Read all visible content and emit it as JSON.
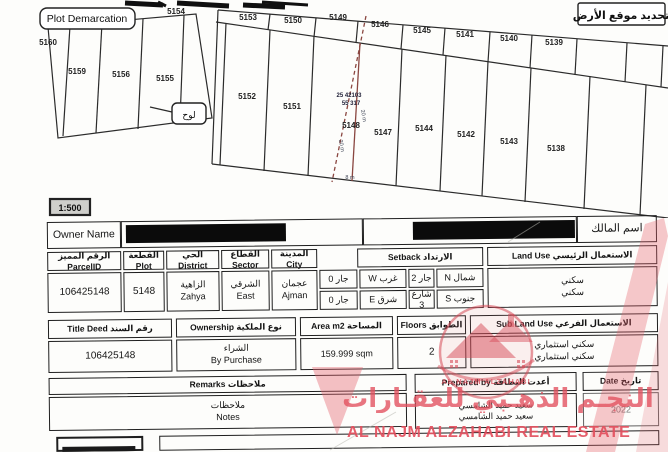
{
  "map": {
    "label_en": "Plot Demarcation",
    "label_ar": "تحديد موقع الأرض",
    "scale": "1:500",
    "callout": "لوح",
    "highlight_plot": {
      "coords_line1": "25 42103",
      "coords_line2": "55 317",
      "dim_left": "20 m",
      "dim_right": "20 m",
      "dim_bottom": "8 m"
    },
    "parcels": [
      {
        "text": "5160",
        "x": 48,
        "y": 45
      },
      {
        "text": "5159",
        "x": 77,
        "y": 74
      },
      {
        "text": "5156",
        "x": 121,
        "y": 77
      },
      {
        "text": "5155",
        "x": 165,
        "y": 81
      },
      {
        "text": "5154",
        "x": 176,
        "y": 14
      },
      {
        "text": "5153",
        "x": 248,
        "y": 20
      },
      {
        "text": "5150",
        "x": 293,
        "y": 23
      },
      {
        "text": "5149",
        "x": 338,
        "y": 20
      },
      {
        "text": "5146",
        "x": 380,
        "y": 27
      },
      {
        "text": "5145",
        "x": 422,
        "y": 33
      },
      {
        "text": "5141",
        "x": 465,
        "y": 37
      },
      {
        "text": "5140",
        "x": 509,
        "y": 41
      },
      {
        "text": "5139",
        "x": 554,
        "y": 45
      },
      {
        "text": "5152",
        "x": 247,
        "y": 99
      },
      {
        "text": "5151",
        "x": 292,
        "y": 109
      },
      {
        "text": "5148",
        "x": 351,
        "y": 128
      },
      {
        "text": "5147",
        "x": 383,
        "y": 135
      },
      {
        "text": "5144",
        "x": 424,
        "y": 131
      },
      {
        "text": "5142",
        "x": 466,
        "y": 137
      },
      {
        "text": "5143",
        "x": 509,
        "y": 144
      },
      {
        "text": "5138",
        "x": 556,
        "y": 151
      }
    ]
  },
  "owner": {
    "label_en": "Owner Name",
    "label_ar": "اسم المالك"
  },
  "fields": {
    "parcel_id": {
      "label": "الرقم المميز ParcelID",
      "value": "106425148"
    },
    "plot": {
      "label": "القطعة Plot",
      "value": "5148"
    },
    "district": {
      "label": "الحي District",
      "value_ar": "الزاهية",
      "value_en": "Zahya"
    },
    "sector": {
      "label": "القطاع Sector",
      "value_ar": "الشرقي",
      "value_en": "East"
    },
    "city": {
      "label": "المدينة City",
      "value_ar": "عجمان",
      "value_en": "Ajman"
    },
    "setback": {
      "label": "الارتداد Setback",
      "north_label": "شمال N",
      "north_value": "جار 2",
      "west_label": "غرب W",
      "west_value": "جار 0",
      "south_label": "جنوب S",
      "south_value": "شارع 3",
      "east_label": "شرق E",
      "east_value": "جار 0"
    },
    "land_use": {
      "label": "الاستعمال الرئيسي Land Use",
      "value1": "سكني",
      "value2": "سكني"
    },
    "title_deed": {
      "label": "رقم السند Title Deed",
      "value": "106425148"
    },
    "ownership": {
      "label": "نوع الملكية Ownership",
      "value_ar": "الشراء",
      "value_en": "By Purchase"
    },
    "area": {
      "label": "المساحة Area m2",
      "value": "159.999 sqm"
    },
    "floors": {
      "label": "الطوابق Floors",
      "value": "2"
    },
    "sub_land_use": {
      "label": "الاستعمال الفرعي Sub Land Use",
      "value1": "سكني استثماري",
      "value2": "سكني استثماري"
    },
    "remarks": {
      "label": "ملاحظات Remarks",
      "value_ar": "ملاحظات",
      "value_en": "Notes"
    },
    "prepared_by": {
      "label": "أعدت البطاقة Prepared by",
      "value1": "سعيد حميد الشامسي",
      "value2": "سعيد حميد الشامسي"
    },
    "date": {
      "label": "تاريخ Date",
      "value": "2022"
    }
  },
  "watermark": {
    "logo_text": "AL NAJM ALZAHABI",
    "arabic": "النجـم الذهـبي للعقـارات",
    "english": "AL NAJM  ALZAHABI REAL ESTATE",
    "color": "#e3505e"
  }
}
